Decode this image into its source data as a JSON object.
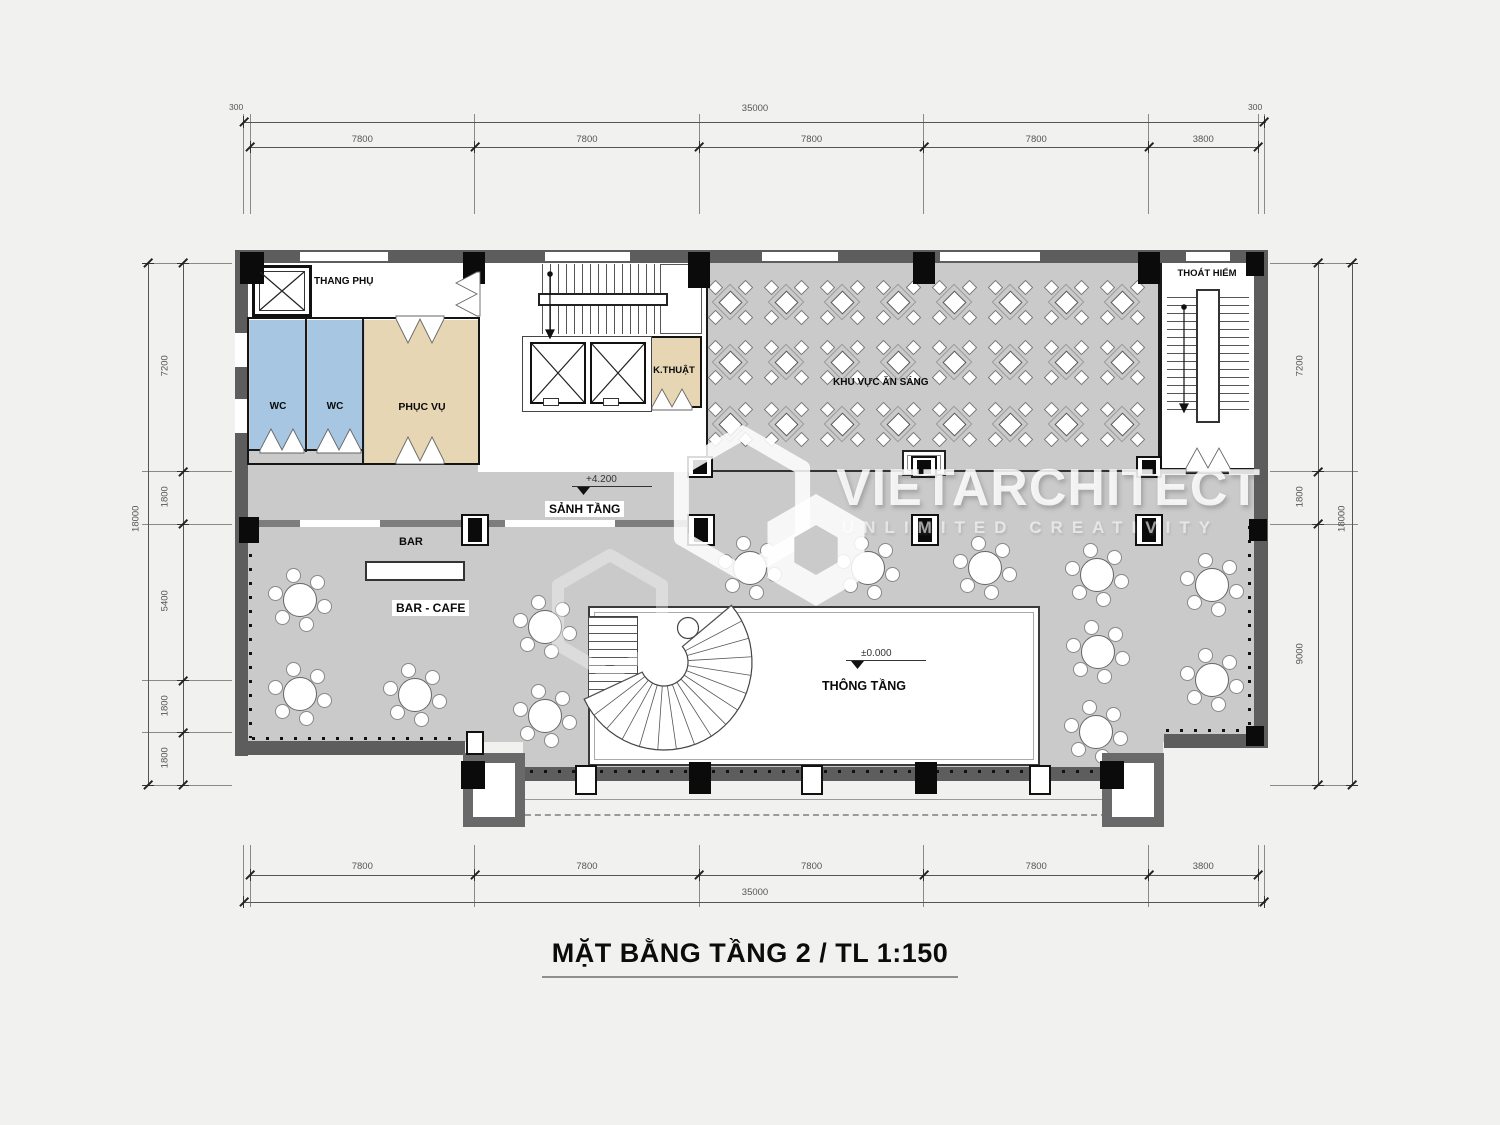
{
  "plan": {
    "title": "MẶT BẰNG TẦNG 2 / TL 1:150",
    "watermark": {
      "brand": "VIETARCHITECT",
      "tagline": "UNLIMITED CREATIVITY"
    },
    "labels": {
      "thang_phu": "THANG PHỤ",
      "wc_left": "WC",
      "wc_right": "WC",
      "phuc_vu": "PHỤC VỤ",
      "k_thuat": "K.THUẬT",
      "an_sang": "KHU VỰC ĂN SÁNG",
      "thoat_hiem": "THOÁT HIỂM",
      "sanh_tang": "SẢNH TẦNG",
      "bar": "BAR",
      "bar_cafe": "BAR - CAFE",
      "thong_tang": "THÔNG TẦNG"
    },
    "levels": {
      "hall": "+4.200",
      "void": "±0.000"
    },
    "dimensions": {
      "top": {
        "overall": "35000",
        "side_offset": "300",
        "segments": [
          "7800",
          "7800",
          "7800",
          "7800",
          "3800"
        ]
      },
      "bottom": {
        "overall": "35000",
        "segments": [
          "7800",
          "7800",
          "7800",
          "7800",
          "3800"
        ]
      },
      "left": {
        "overall": "18000",
        "segments": [
          "7200",
          "1800",
          "5400",
          "1800",
          "1800"
        ]
      },
      "right": {
        "overall": "18000",
        "segments": [
          "7200",
          "1800",
          "9000"
        ]
      }
    },
    "colors": {
      "background": "#f1f1f0",
      "floor": "#c9cac9",
      "wall": "#5d5d5d",
      "wc_room": "#a7c6e2",
      "service_room": "#e6d6b4",
      "dim_text": "#555555"
    },
    "furniture": {
      "round_tables": [
        [
          300,
          600
        ],
        [
          300,
          694
        ],
        [
          415,
          695
        ],
        [
          545,
          627
        ],
        [
          545,
          716
        ],
        [
          750,
          568
        ],
        [
          868,
          568
        ],
        [
          985,
          568
        ],
        [
          1097,
          575
        ],
        [
          1212,
          585
        ],
        [
          1098,
          652
        ],
        [
          1212,
          680
        ],
        [
          1096,
          732
        ]
      ],
      "square_tables": {
        "cols": [
          730,
          786,
          842,
          898,
          954,
          1010,
          1066,
          1122
        ],
        "rows": [
          302,
          362,
          424
        ]
      }
    }
  }
}
